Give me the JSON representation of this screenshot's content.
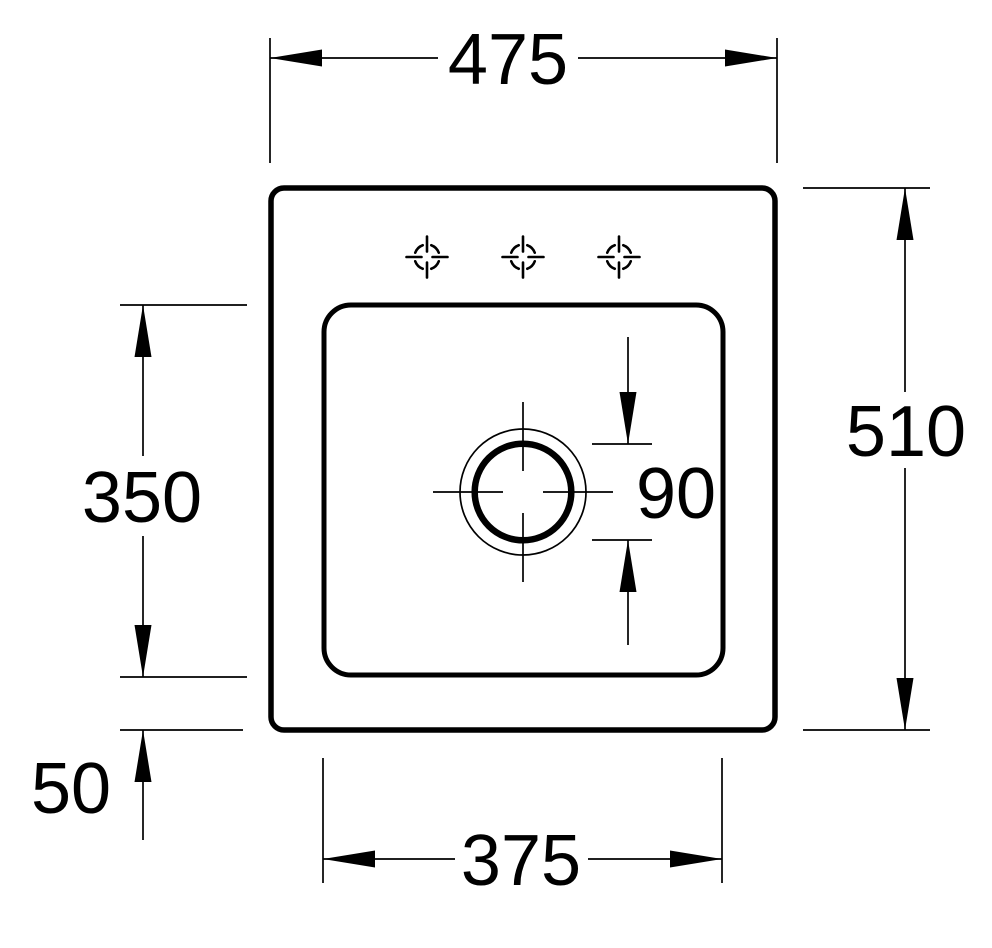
{
  "drawing": {
    "colors": {
      "line": "#000000",
      "background": "#ffffff"
    },
    "dims": {
      "overall_width": "475",
      "overall_depth": "510",
      "basin_depth": "350",
      "basin_width": "375",
      "drain_diameter": "90",
      "front_rim_offset": "50"
    },
    "tap_holes": {
      "count": 3
    }
  }
}
